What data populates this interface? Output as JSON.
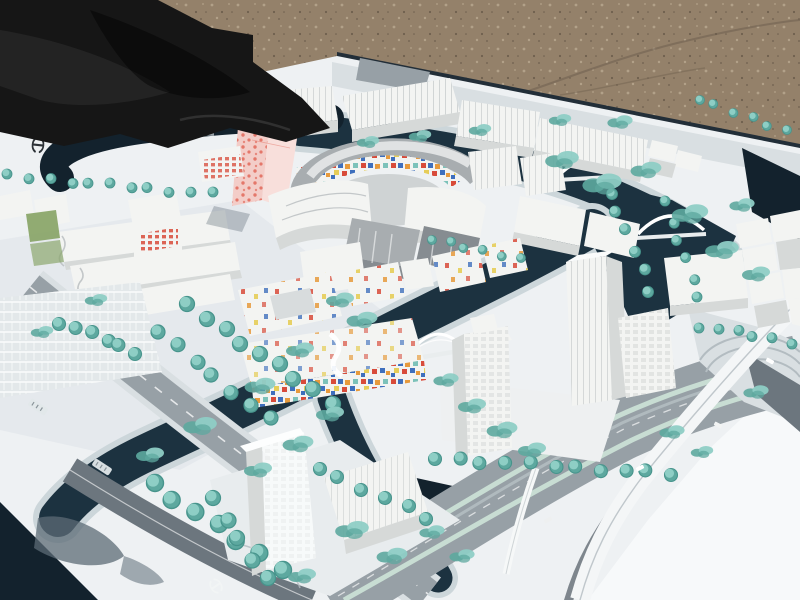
{
  "image": {
    "type": "photograph",
    "subject": "architectural scale model of a waterfront urban masterplan",
    "setting": "white model board lying outdoors on gravel ground, top-left corner covered by a black tarp"
  },
  "palette": {
    "tarp": "#161616",
    "tarp-fold": "#303030",
    "gravel": "#94816a",
    "gravel-dark": "#6e5f4e",
    "gravel-light": "#b2a189",
    "board": "#eef1f3",
    "board-dim": "#d9e1e6",
    "board-bright": "#f7f9fa",
    "edge-shadow": "#222e38",
    "water": "#1c3240",
    "water-deep": "#13222d",
    "bank": "#ccd6da",
    "road": "#97a0a6",
    "road-dark": "#6c767e",
    "road-light": "#b3bcc1",
    "sidewalk": "#d9dfe2",
    "median": "#c8ddd3",
    "tree": "#8ecec5",
    "tree-dark": "#5da89f",
    "tree-stroke": "#47948c",
    "bldg": "#f3f4f2",
    "bldg-side": "#d6d9d8",
    "bldg-shadow": "#b6bcbe",
    "metal": "#a8adb0",
    "metal-dark": "#868c91",
    "pink": "#f3cdc8",
    "pink-light": "#f8dfdb",
    "pink-dot": "#e4776a",
    "accent-red": "#d84b3a",
    "accent-orange": "#e79a3c",
    "accent-blue": "#3e6fbd",
    "accent-yellow": "#e6cd58",
    "accent-teal": "#7cc2ba",
    "grass": "#86a364",
    "glyph-dark": "#2d3237",
    "white": "#ffffff",
    "shadow": "#5c6b76"
  },
  "labels": {
    "scene": "photograph of an architectural scale model of a canal-side city district",
    "ground": "gravel ground",
    "tarp": "black fabric tarp covering the top-left corner of the model",
    "board": "white model base board",
    "perimeter_road": "perimeter road along the far board edge",
    "top_canal": "upper canal behind the central buildings",
    "main_canal": "main canal curving through the model",
    "branch_canal": "branch canal toward the bottom island",
    "right_channel": "side channel beside the eastern blocks",
    "left_canal": "canal loop at the left board corner",
    "left_bridge": "flat gray bridge over the left canal loop",
    "arch_bridge_1": "white arch bridge over the upper canal",
    "arch_bridge_2": "white arch bridge over the eastern channel",
    "truss_bridge": "white truss arch bridge over the main canal",
    "foot_bridge": "white footbridge across the boulevard",
    "pink_tower": "twisted pink landmark tower with red dot facade",
    "circle_complex": "elliptical courtyard complex with multicolored mosaic inner facade",
    "top_row": "row of white ribbed-roof slab buildings along the upper canal",
    "left_cluster": "white wavy-edged slab buildings on the west side",
    "parking": "striped parking lot at the west edge",
    "colorful_cluster": "low-rise housing blocks with scattered colored facade panels",
    "mosaic_block": "low-rise block with dense colored mosaic facade band",
    "gray_slabs": "metallic gray slab buildings east of the ellipse",
    "right_island_towers": "white high-rise towers on the eastern island",
    "cube_cluster": "cluster of white cubic blocks at the right edge",
    "bottom_tower": "translucent white high-rise tower on the southern island",
    "boulevard": "multi-lane boulevard with planted medians",
    "flyover": "white curved flyover ramp at the lower right",
    "plaza": "paved plaza with concentric steps on the east side",
    "left_road": "main avenue running along the west side",
    "station_marker_left": "dark transit logo printed on the board at the left",
    "station_marker_road": "white transit logo painted on the lower road",
    "road_label_1": "small illegible street-name plate",
    "road_label_2": "small illegible street-name plate",
    "vegetation": "teal model trees and shrubs",
    "cars": "tiny white model cars",
    "shadow_blob": "cast shadow of the southern tower on the white margin"
  },
  "vegetation": {
    "rows": [
      {
        "x1": 10,
        "y1": 176,
        "x2": 210,
        "y2": 194,
        "n": 11,
        "r": 5
      },
      {
        "x1": 697,
        "y1": 100,
        "x2": 788,
        "y2": 130,
        "n": 6,
        "r": 4.5
      },
      {
        "x1": 610,
        "y1": 192,
        "x2": 650,
        "y2": 290,
        "n": 6,
        "r": 5.5
      },
      {
        "x1": 664,
        "y1": 202,
        "x2": 700,
        "y2": 298,
        "n": 6,
        "r": 5
      },
      {
        "x1": 435,
        "y1": 458,
        "x2": 672,
        "y2": 474,
        "n": 11,
        "r": 6.5
      },
      {
        "x1": 188,
        "y1": 306,
        "x2": 332,
        "y2": 402,
        "n": 9,
        "r": 7.5
      },
      {
        "x1": 160,
        "y1": 332,
        "x2": 268,
        "y2": 420,
        "n": 7,
        "r": 7
      },
      {
        "x1": 62,
        "y1": 322,
        "x2": 135,
        "y2": 352,
        "n": 6,
        "r": 6.5
      },
      {
        "x1": 152,
        "y1": 484,
        "x2": 282,
        "y2": 568,
        "n": 7,
        "r": 8.5
      },
      {
        "x1": 318,
        "y1": 468,
        "x2": 428,
        "y2": 518,
        "n": 6,
        "r": 6.5
      },
      {
        "x1": 212,
        "y1": 500,
        "x2": 266,
        "y2": 578,
        "n": 5,
        "r": 7.5
      },
      {
        "x1": 432,
        "y1": 240,
        "x2": 518,
        "y2": 258,
        "n": 6,
        "r": 4.5
      },
      {
        "x1": 700,
        "y1": 326,
        "x2": 790,
        "y2": 342,
        "n": 6,
        "r": 5
      }
    ],
    "shrubs": [
      {
        "x": 562,
        "y": 160,
        "s": 1.2
      },
      {
        "x": 602,
        "y": 184,
        "s": 1.4
      },
      {
        "x": 646,
        "y": 170,
        "s": 1.1
      },
      {
        "x": 690,
        "y": 214,
        "s": 1.3
      },
      {
        "x": 722,
        "y": 250,
        "s": 1.2
      },
      {
        "x": 756,
        "y": 274,
        "s": 1.0
      },
      {
        "x": 742,
        "y": 205,
        "s": 0.9
      },
      {
        "x": 340,
        "y": 300,
        "s": 1.0
      },
      {
        "x": 362,
        "y": 320,
        "s": 1.1
      },
      {
        "x": 300,
        "y": 350,
        "s": 1.0
      },
      {
        "x": 260,
        "y": 386,
        "s": 1.1
      },
      {
        "x": 200,
        "y": 426,
        "s": 1.2
      },
      {
        "x": 150,
        "y": 455,
        "s": 1.0
      },
      {
        "x": 330,
        "y": 414,
        "s": 1.0
      },
      {
        "x": 298,
        "y": 444,
        "s": 1.1
      },
      {
        "x": 258,
        "y": 470,
        "s": 1.0
      },
      {
        "x": 446,
        "y": 380,
        "s": 0.9
      },
      {
        "x": 472,
        "y": 406,
        "s": 1.0
      },
      {
        "x": 502,
        "y": 430,
        "s": 1.1
      },
      {
        "x": 532,
        "y": 450,
        "s": 1.0
      },
      {
        "x": 352,
        "y": 530,
        "s": 1.2
      },
      {
        "x": 392,
        "y": 556,
        "s": 1.1
      },
      {
        "x": 302,
        "y": 576,
        "s": 1.0
      },
      {
        "x": 432,
        "y": 532,
        "s": 0.9
      },
      {
        "x": 462,
        "y": 556,
        "s": 0.9
      },
      {
        "x": 96,
        "y": 300,
        "s": 0.8
      },
      {
        "x": 42,
        "y": 332,
        "s": 0.8
      },
      {
        "x": 620,
        "y": 122,
        "s": 0.9
      },
      {
        "x": 560,
        "y": 120,
        "s": 0.8
      },
      {
        "x": 480,
        "y": 130,
        "s": 0.8
      },
      {
        "x": 420,
        "y": 136,
        "s": 0.8
      },
      {
        "x": 368,
        "y": 142,
        "s": 0.8
      },
      {
        "x": 756,
        "y": 392,
        "s": 0.9
      },
      {
        "x": 672,
        "y": 432,
        "s": 0.9
      },
      {
        "x": 702,
        "y": 452,
        "s": 0.8
      }
    ]
  }
}
